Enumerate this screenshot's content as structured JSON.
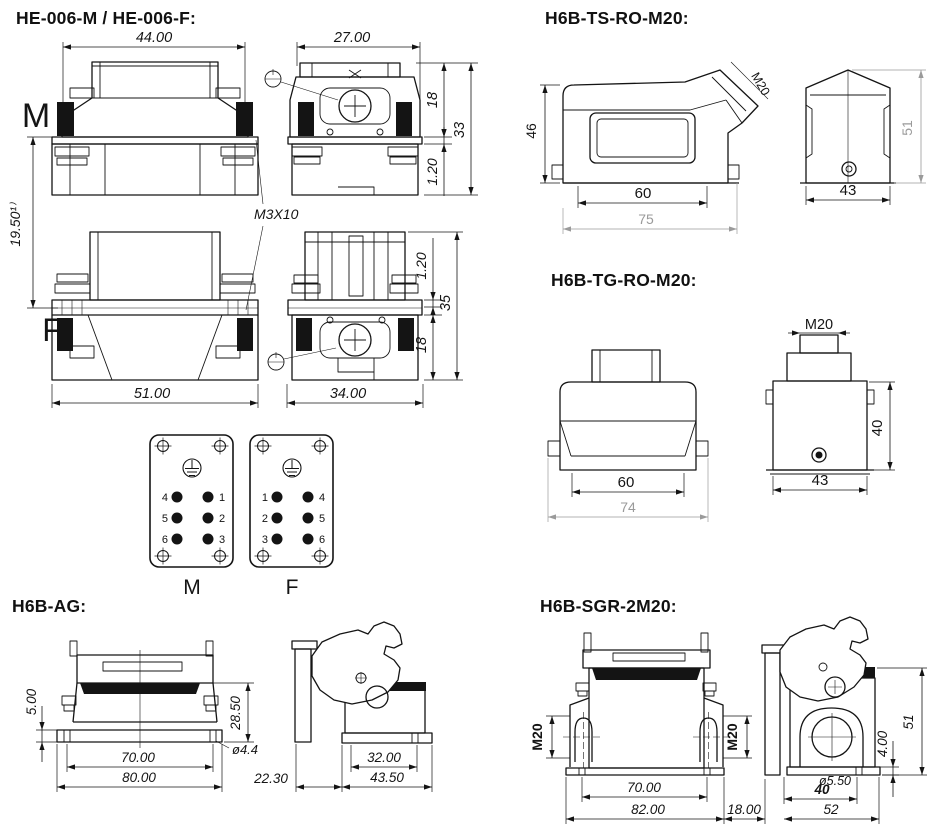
{
  "sections": {
    "he006": {
      "title": "HE-006-M / HE-006-F:",
      "view_label_m": "M",
      "view_label_f": "F",
      "dims": {
        "w44": "44.00",
        "w27": "27.00",
        "h18_top": "18",
        "h33": "33",
        "h120_top": "1.20",
        "v1950": "19.50¹⁾",
        "thread": "M3X10",
        "w51": "51.00",
        "w34": "34.00",
        "h120_bot": "1.20",
        "h35": "35",
        "h18_bot": "18"
      },
      "pinplates": {
        "m_label": "M",
        "f_label": "F",
        "m_left": [
          "4",
          "5",
          "6"
        ],
        "m_right": [
          "1",
          "2",
          "3"
        ],
        "f_left": [
          "1",
          "2",
          "3"
        ],
        "f_right": [
          "4",
          "5",
          "6"
        ]
      }
    },
    "ts": {
      "title": "H6B-TS-RO-M20:",
      "dims": {
        "h46": "46",
        "w60": "60",
        "w75": "75",
        "thread": "M20",
        "h51": "51",
        "w43": "43"
      }
    },
    "tg": {
      "title": "H6B-TG-RO-M20:",
      "dims": {
        "w60": "60",
        "w74": "74",
        "thread": "M20",
        "h40": "40",
        "w43": "43"
      }
    },
    "ag": {
      "title": "H6B-AG:",
      "dims": {
        "h5": "5.00",
        "h285": "28.50",
        "dia44": "ø4.4",
        "w70": "70.00",
        "w80": "80.00",
        "w2230": "22.30",
        "w32": "32.00",
        "w435": "43.50"
      }
    },
    "sgr": {
      "title": "H6B-SGR-2M20:",
      "dims": {
        "m20_left": "M20",
        "m20_right": "M20",
        "w70": "70.00",
        "w82": "82.00",
        "gap18": "18.00",
        "dia550": "ø5.50",
        "w40": "40",
        "w52": "52",
        "h4": "4.00",
        "h51": "51"
      }
    }
  },
  "colors": {
    "ink": "#141414",
    "dim_gray": "#9a9a9a"
  }
}
